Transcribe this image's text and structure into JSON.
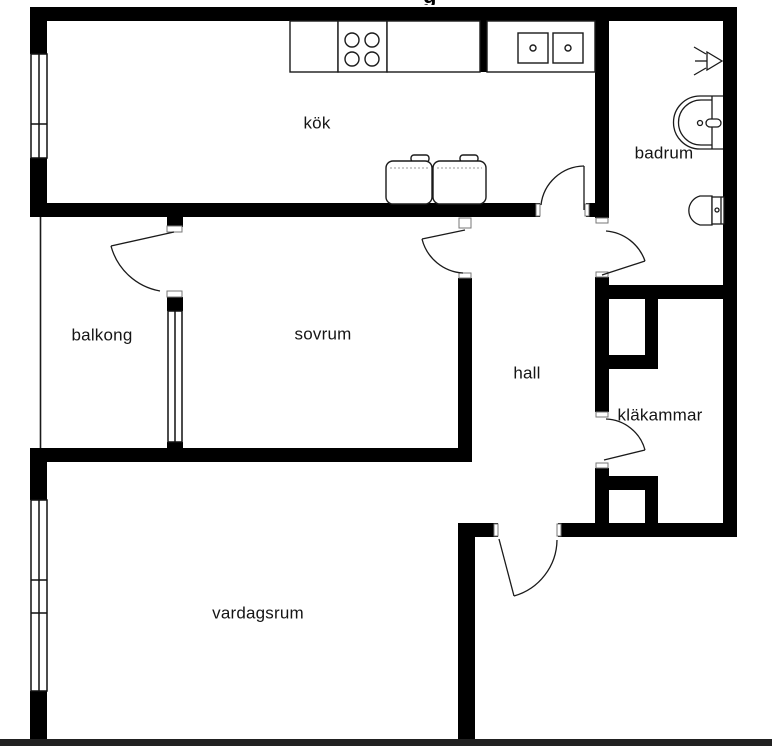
{
  "title_fragment": "g",
  "rooms": [
    {
      "id": "kok",
      "label": "kök"
    },
    {
      "id": "badrum",
      "label": "badrum"
    },
    {
      "id": "balkong",
      "label": "balkong"
    },
    {
      "id": "sovrum",
      "label": "sovrum"
    },
    {
      "id": "hall",
      "label": "hall"
    },
    {
      "id": "klakammar",
      "label": "kläkammar"
    },
    {
      "id": "vardagsrum",
      "label": "vardagsrum"
    }
  ],
  "fixtures": [
    "kitchen-counter",
    "stove-four-burners-icon",
    "double-sink-icon",
    "fridge-icon",
    "freezer-icon",
    "shower-icon",
    "washbasin-icon",
    "toilet-icon"
  ],
  "legend": {
    "wall_color": "#000000",
    "background_color": "#ffffff",
    "line_color": "#1a1a1a",
    "bottom_bar_color": "#212121",
    "door_count": 6,
    "window_count": 3
  }
}
